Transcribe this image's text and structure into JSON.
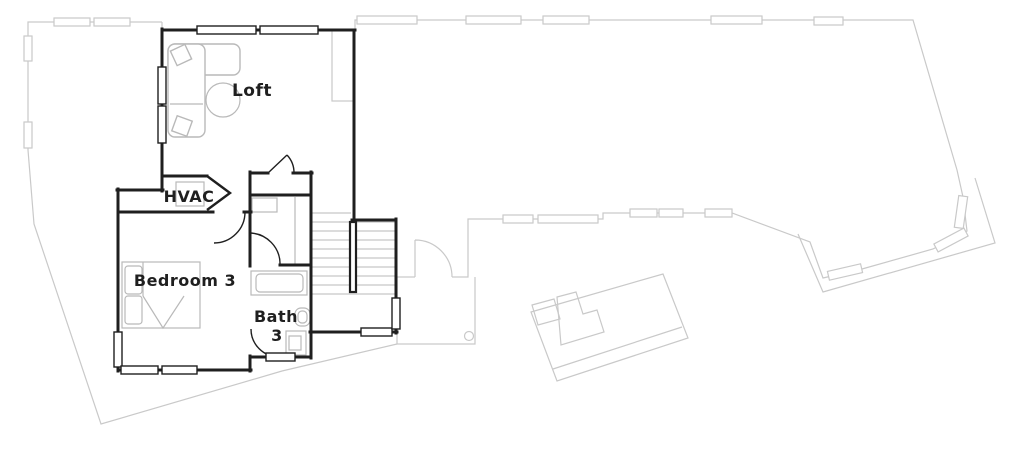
{
  "plan": {
    "kind": "floor-plan",
    "rooms": {
      "loft": {
        "label": "Loft"
      },
      "hvac": {
        "label": "HVAC"
      },
      "bedroom3": {
        "label": "Bedroom 3"
      },
      "bath3": {
        "label_line1": "Bath",
        "label_line2": "3"
      }
    }
  },
  "colors": {
    "wall": "#1f1f1f",
    "floor_below": "#c9c9c9",
    "furniture": "#b9b9b9",
    "stair_tread": "#c6c6c6",
    "background": "#ffffff"
  }
}
